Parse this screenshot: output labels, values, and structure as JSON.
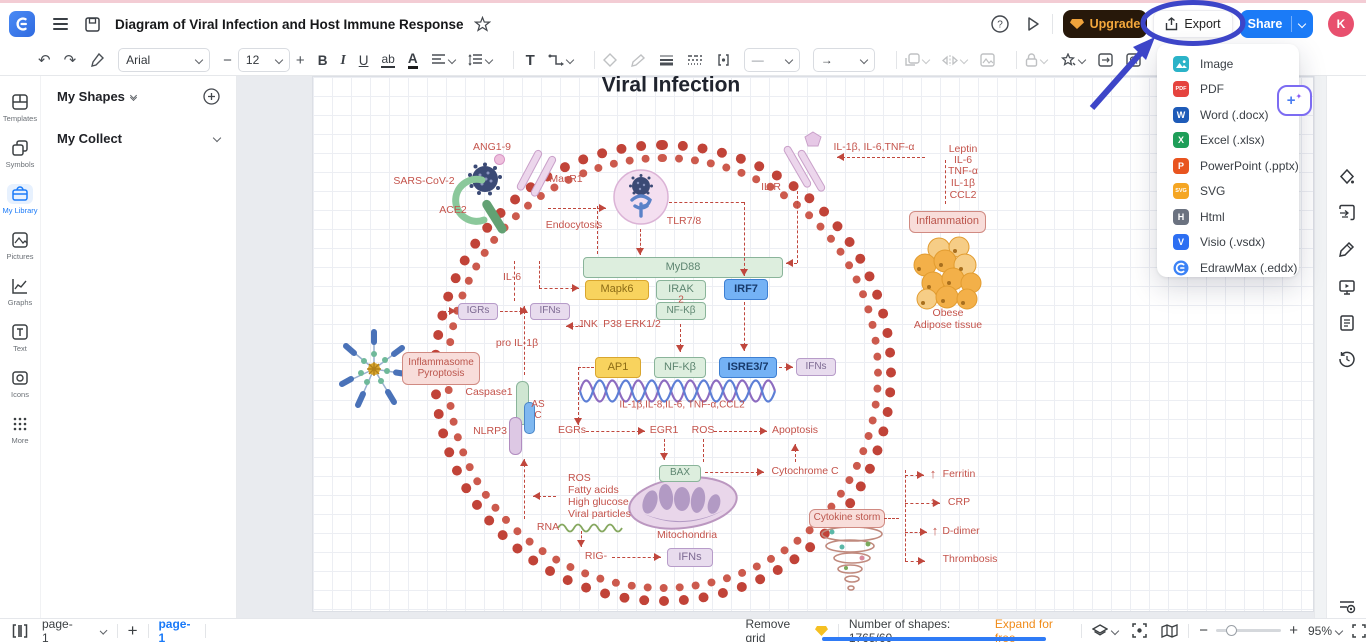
{
  "header": {
    "title": "Diagram of Viral Infection and Host Immune Response",
    "upgrade_label": "Upgrade",
    "export_label": "Export",
    "share_label": "Share",
    "avatar_initial": "K"
  },
  "toolbar": {
    "font": "Arial",
    "font_size": "12",
    "bold": "B",
    "italic": "I",
    "underline": "U",
    "strike": "ab",
    "font_color": "A",
    "text_tool": "T",
    "minus": "−",
    "plus": "+",
    "line_glyph": "—",
    "arrow_glyph": "→",
    "undo": "↶",
    "redo": "↷"
  },
  "left_rail": {
    "items": [
      {
        "label": "Templates"
      },
      {
        "label": "Symbols"
      },
      {
        "label": "My Library",
        "active": true
      },
      {
        "label": "Pictures"
      },
      {
        "label": "Graphs"
      },
      {
        "label": "Text"
      },
      {
        "label": "Icons"
      },
      {
        "label": "More"
      }
    ]
  },
  "left_panel": {
    "my_shapes": "My Shapes",
    "my_collect": "My Collect"
  },
  "export_menu": {
    "items": [
      {
        "label": "Image",
        "icon": "image",
        "color": "#2bb3c8"
      },
      {
        "label": "PDF",
        "icon": "PDF",
        "color": "#e5433e"
      },
      {
        "label": "Word (.docx)",
        "icon": "W",
        "color": "#1e5bb8"
      },
      {
        "label": "Excel (.xlsx)",
        "icon": "X",
        "color": "#1e9e58"
      },
      {
        "label": "PowerPoint (.pptx)",
        "icon": "P",
        "color": "#e8541f"
      },
      {
        "label": "SVG",
        "icon": "SVG",
        "color": "#f5a623"
      },
      {
        "label": "Html",
        "icon": "H",
        "color": "#6b7280"
      },
      {
        "label": "Visio (.vsdx)",
        "icon": "V",
        "color": "#2d6ff2"
      },
      {
        "label": "EdrawMax (.eddx)",
        "icon": "edraw",
        "color": "#3b82f6"
      }
    ]
  },
  "footer": {
    "page_select": "page-1",
    "page_tab": "page-1",
    "remove_grid": "Remove grid",
    "shapes_count": "Number of shapes: 1765/60",
    "expand": "Expand for free",
    "zoom": "95%",
    "minus": "−",
    "plus": "+",
    "add_page": "+"
  },
  "canvas": {
    "title": "Viral Infection",
    "boxes": [
      {
        "label": "MyD88",
        "x": 583,
        "y": 257,
        "w": 200,
        "h": 21,
        "type": "green"
      },
      {
        "label": "Mapk6",
        "x": 585,
        "y": 280,
        "w": 64,
        "h": 20,
        "type": "yellow"
      },
      {
        "label": "IRAK",
        "x": 656,
        "y": 280,
        "w": 50,
        "h": 20,
        "type": "green"
      },
      {
        "label": "NF-Kβ",
        "x": 656,
        "y": 302,
        "w": 50,
        "h": 18,
        "type": "green",
        "fs": 10
      },
      {
        "label": "IRF7",
        "x": 724,
        "y": 279,
        "w": 44,
        "h": 21,
        "type": "blue"
      },
      {
        "label": "IGRs",
        "x": 458,
        "y": 303,
        "w": 40,
        "h": 17,
        "type": "lav",
        "fs": 10
      },
      {
        "label": "IFNs",
        "x": 530,
        "y": 303,
        "w": 40,
        "h": 17,
        "type": "lav",
        "fs": 10
      },
      {
        "label": "Inflammasome\nPyroptosis",
        "x": 402,
        "y": 352,
        "w": 78,
        "h": 33,
        "type": "pinkbox",
        "fs": 10
      },
      {
        "label": "",
        "x": 516,
        "y": 381,
        "w": 13,
        "h": 44,
        "type": "pillg"
      },
      {
        "label": "",
        "x": 524,
        "y": 402,
        "w": 11,
        "h": 32,
        "type": "pillb"
      },
      {
        "label": "",
        "x": 509,
        "y": 417,
        "w": 13,
        "h": 38,
        "type": "pilll"
      },
      {
        "label": "AP1",
        "x": 595,
        "y": 357,
        "w": 46,
        "h": 21,
        "type": "yellow"
      },
      {
        "label": "NF-Kβ",
        "x": 654,
        "y": 357,
        "w": 52,
        "h": 21,
        "type": "green"
      },
      {
        "label": "ISRE3/7",
        "x": 719,
        "y": 357,
        "w": 58,
        "h": 21,
        "type": "blue"
      },
      {
        "label": "IFNs",
        "x": 796,
        "y": 358,
        "w": 40,
        "h": 18,
        "type": "lav",
        "fs": 10
      },
      {
        "label": "BAX",
        "x": 659,
        "y": 465,
        "w": 42,
        "h": 17,
        "type": "green",
        "fs": 10
      },
      {
        "label": "IFNs",
        "x": 667,
        "y": 548,
        "w": 46,
        "h": 19,
        "type": "lav"
      },
      {
        "label": "Inflammation",
        "x": 909,
        "y": 211,
        "w": 77,
        "h": 22,
        "type": "pinkbox"
      },
      {
        "label": "Cytokine storm",
        "x": 809,
        "y": 509,
        "w": 76,
        "h": 19,
        "type": "pinkbox",
        "fs": 10
      }
    ],
    "labels": [
      {
        "t": "Viral Infection",
        "x": 671,
        "y": 85,
        "size": 21,
        "bold": 1,
        "color": "#20242e"
      },
      {
        "t": "ANG1-9",
        "x": 492,
        "y": 148
      },
      {
        "t": "SARS-CoV-2",
        "x": 424,
        "y": 182
      },
      {
        "t": "ACE2",
        "x": 453,
        "y": 211
      },
      {
        "t": "MasR1",
        "x": 566,
        "y": 180
      },
      {
        "t": "Endocytosis",
        "x": 574,
        "y": 226
      },
      {
        "t": "TLR7/8",
        "x": 684,
        "y": 222
      },
      {
        "t": "IL-R",
        "x": 771,
        "y": 188
      },
      {
        "t": "IL-1β, IL-6,TNF-α",
        "x": 874,
        "y": 148
      },
      {
        "t": "Leptin",
        "x": 963,
        "y": 150
      },
      {
        "t": "IL-6",
        "x": 963,
        "y": 161
      },
      {
        "t": "TNF-α",
        "x": 963,
        "y": 172
      },
      {
        "t": "IL-1β",
        "x": 963,
        "y": 184
      },
      {
        "t": "CCL2",
        "x": 963,
        "y": 196
      },
      {
        "t": "Obese",
        "x": 948,
        "y": 314
      },
      {
        "t": "Adipose tissue",
        "x": 948,
        "y": 326
      },
      {
        "t": "IL-6",
        "x": 512,
        "y": 278
      },
      {
        "t": "2",
        "x": 681,
        "y": 300,
        "size": 10
      },
      {
        "t": "JNK",
        "x": 588,
        "y": 325
      },
      {
        "t": "P38 ERK1/2",
        "x": 632,
        "y": 325
      },
      {
        "t": "pro IL-1β",
        "x": 517,
        "y": 344
      },
      {
        "t": "Caspase1",
        "x": 489,
        "y": 393
      },
      {
        "t": "AS\nC",
        "x": 538,
        "y": 410,
        "size": 10
      },
      {
        "t": "NLRP3",
        "x": 490,
        "y": 432
      },
      {
        "t": "IL-1β,IL-8,IL-6, TNF-α,CCL2",
        "x": 682,
        "y": 405,
        "size": 10
      },
      {
        "t": "EGRs",
        "x": 572,
        "y": 431
      },
      {
        "t": "EGR1",
        "x": 664,
        "y": 431
      },
      {
        "t": "ROS",
        "x": 703,
        "y": 431
      },
      {
        "t": "Apoptosis",
        "x": 795,
        "y": 431
      },
      {
        "t": "Cytochrome C",
        "x": 805,
        "y": 472
      },
      {
        "t": "Mitochondria",
        "x": 687,
        "y": 536
      },
      {
        "t": "ROS",
        "x": 568,
        "y": 479,
        "left": 1
      },
      {
        "t": "Fatty acids",
        "x": 568,
        "y": 491,
        "left": 1
      },
      {
        "t": "High glucose",
        "x": 568,
        "y": 503,
        "left": 1
      },
      {
        "t": "Viral particles",
        "x": 568,
        "y": 515,
        "left": 1
      },
      {
        "t": "RNA",
        "x": 548,
        "y": 528
      },
      {
        "t": "RIG-",
        "x": 596,
        "y": 557
      },
      {
        "t": "Ferritin",
        "x": 959,
        "y": 475
      },
      {
        "t": "CRP",
        "x": 959,
        "y": 503
      },
      {
        "t": "D-dimer",
        "x": 961,
        "y": 532
      },
      {
        "t": "Thrombosis",
        "x": 970,
        "y": 560
      },
      {
        "t": "↑",
        "x": 933,
        "y": 474,
        "bold": 1,
        "size": 13
      },
      {
        "t": "↑",
        "x": 933,
        "y": 502,
        "bold": 1,
        "size": 13
      },
      {
        "t": "↑",
        "x": 935,
        "y": 531,
        "bold": 1,
        "size": 13
      }
    ],
    "arrows": [
      [
        548,
        208,
        606,
        208,
        1
      ],
      [
        597,
        206,
        597,
        254,
        0
      ],
      [
        640,
        229,
        640,
        255,
        1
      ],
      [
        669,
        202,
        744,
        202,
        0
      ],
      [
        744,
        202,
        744,
        276,
        1
      ],
      [
        797,
        191,
        797,
        263,
        0
      ],
      [
        797,
        263,
        786,
        263,
        1
      ],
      [
        925,
        157,
        837,
        157,
        1
      ],
      [
        945,
        160,
        945,
        204,
        0
      ],
      [
        539,
        261,
        539,
        288,
        0
      ],
      [
        539,
        288,
        579,
        288,
        1
      ],
      [
        514,
        261,
        514,
        301,
        0
      ],
      [
        524,
        375,
        524,
        306,
        1
      ],
      [
        500,
        311,
        527,
        311,
        1
      ],
      [
        443,
        311,
        456,
        311,
        1
      ],
      [
        583,
        326,
        566,
        326,
        1
      ],
      [
        680,
        324,
        680,
        352,
        1
      ],
      [
        744,
        302,
        744,
        351,
        1
      ],
      [
        779,
        367,
        793,
        367,
        1
      ],
      [
        594,
        367,
        578,
        367,
        0
      ],
      [
        578,
        367,
        578,
        425,
        1
      ],
      [
        586,
        431,
        645,
        431,
        1
      ],
      [
        664,
        439,
        664,
        460,
        1
      ],
      [
        714,
        431,
        767,
        431,
        1
      ],
      [
        703,
        439,
        703,
        462,
        0
      ],
      [
        705,
        472,
        764,
        472,
        1
      ],
      [
        795,
        462,
        795,
        444,
        1
      ],
      [
        524,
        519,
        524,
        459,
        1
      ],
      [
        556,
        496,
        533,
        496,
        1
      ],
      [
        581,
        531,
        581,
        547,
        1
      ],
      [
        612,
        557,
        661,
        557,
        1
      ],
      [
        884,
        518,
        899,
        518,
        0
      ],
      [
        905,
        470,
        905,
        561,
        0
      ],
      [
        905,
        475,
        924,
        475,
        1
      ],
      [
        905,
        503,
        940,
        503,
        1
      ],
      [
        905,
        532,
        927,
        532,
        1
      ],
      [
        905,
        561,
        925,
        561,
        1
      ]
    ]
  }
}
